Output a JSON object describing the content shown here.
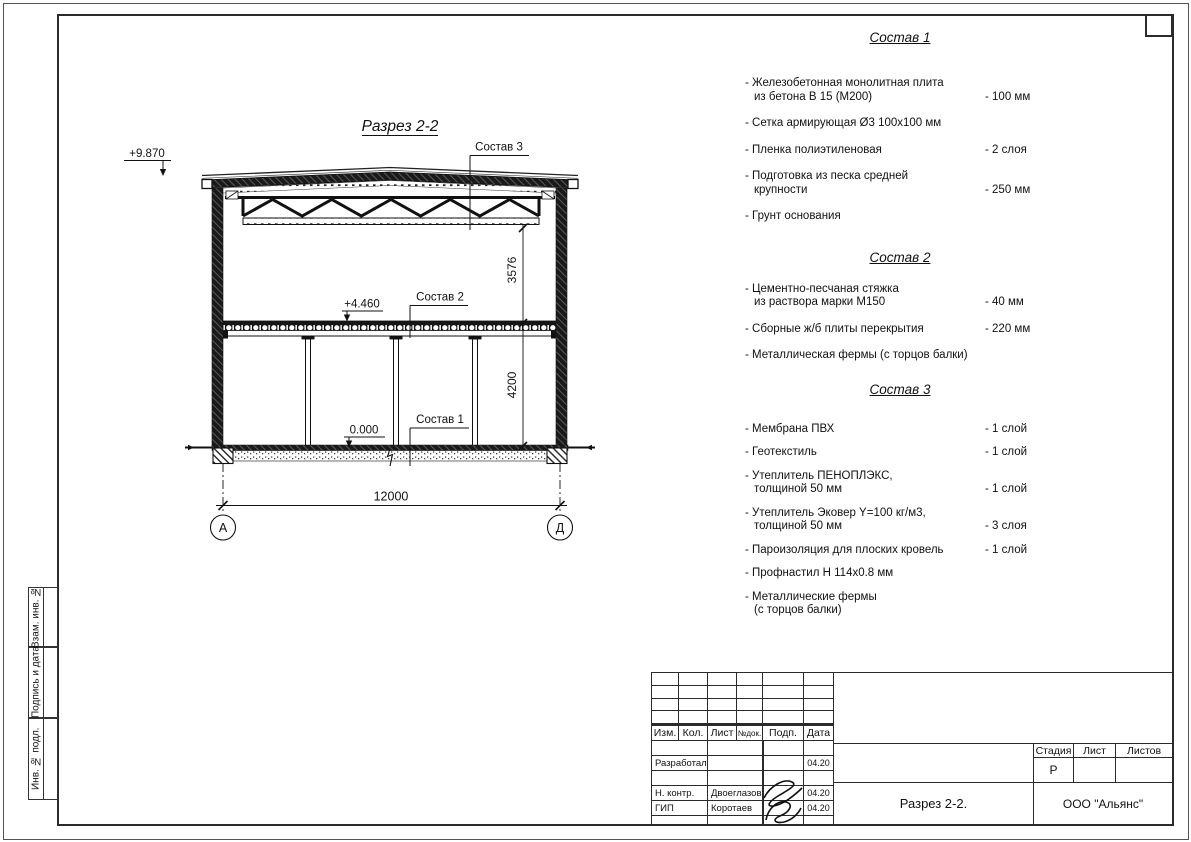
{
  "drawing": {
    "title": "Разрез 2-2",
    "elevation_top": "+9.870",
    "elevation_mid": "+4.460",
    "elevation_zero": "0.000",
    "leader_sostav1": "Состав 1",
    "leader_sostav2": "Состав 2",
    "leader_sostav3": "Состав 3",
    "dim_truss_height": "3576",
    "dim_floor_height": "4200",
    "dim_span": "12000",
    "axis_left": "А",
    "axis_right": "Д"
  },
  "specs": [
    {
      "title": "Состав 1",
      "items": [
        {
          "name_lines": [
            "- Железобетонная монолитная плита",
            "из бетона В 15 (М200)"
          ],
          "value": "- 100 мм"
        },
        {
          "name_lines": [
            "- Сетка армирующая Ø3 100х100 мм"
          ],
          "value": ""
        },
        {
          "name_lines": [
            "- Пленка полиэтиленовая"
          ],
          "value": "- 2 слоя"
        },
        {
          "name_lines": [
            "- Подготовка из песка средней",
            "крупности"
          ],
          "value": "- 250 мм"
        },
        {
          "name_lines": [
            "- Грунт основания"
          ],
          "value": ""
        }
      ]
    },
    {
      "title": "Состав 2",
      "items": [
        {
          "name_lines": [
            "- Цементно-песчаная стяжка",
            "из раствора марки М150"
          ],
          "value": "- 40 мм"
        },
        {
          "name_lines": [
            "- Сборные ж/б плиты перекрытия"
          ],
          "value": "- 220 мм"
        },
        {
          "name_lines": [
            "- Металлическая фермы (с торцов балки)"
          ],
          "value": ""
        }
      ]
    },
    {
      "title": "Состав 3",
      "items": [
        {
          "name_lines": [
            "- Мембрана ПВХ"
          ],
          "value": "- 1 слой"
        },
        {
          "name_lines": [
            "- Геотекстиль"
          ],
          "value": "- 1 слой"
        },
        {
          "name_lines": [
            "- Утеплитель ПЕНОПЛЭКС,",
            "толщиной 50 мм"
          ],
          "value": "- 1 слой"
        },
        {
          "name_lines": [
            "- Утеплитель Эковер Y=100 кг/м3,",
            "толщиной 50 мм"
          ],
          "value": "- 3 слоя"
        },
        {
          "name_lines": [
            "- Пароизоляция для плоских кровель"
          ],
          "value": "- 1 слой"
        },
        {
          "name_lines": [
            "- Профнастил Н 114х0.8 мм"
          ],
          "value": ""
        },
        {
          "name_lines": [
            "- Металлические фермы",
            "(с торцов балки)"
          ],
          "value": ""
        }
      ]
    }
  ],
  "titleblock": {
    "header": [
      "Изм.",
      "Кол.",
      "Лист",
      "№док.",
      "Подп.",
      "Дата"
    ],
    "rows": [
      {
        "role": "Разработал",
        "name": "",
        "date": "04.20"
      },
      {
        "role": "Н. контр.",
        "name": "Двоеглазов",
        "date": "04.20"
      },
      {
        "role": "ГИП",
        "name": "Коротаев",
        "date": "04.20"
      }
    ],
    "doc_title": "Разрез 2-2.",
    "company": "ООО \"Альянс\"",
    "stage_label": "Стадия",
    "sheet_label": "Лист",
    "sheets_label": "Листов",
    "stage_value": "Р"
  },
  "sidebar": {
    "labels": [
      "Взам. инв. №",
      "Подпись и дата",
      "Инв. № подл."
    ]
  }
}
